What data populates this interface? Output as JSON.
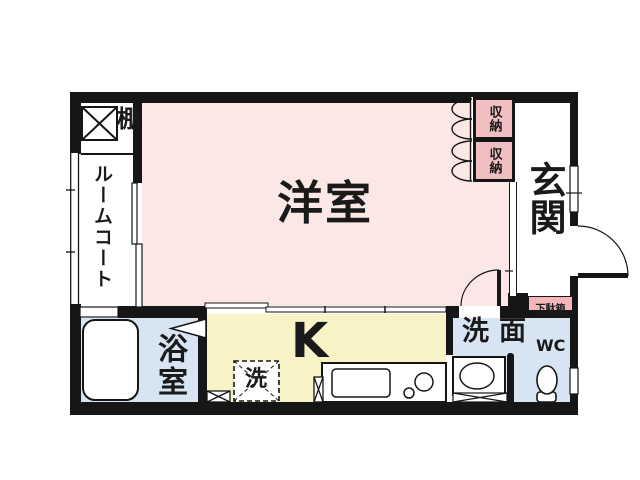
{
  "labels": {
    "western_room": "洋室",
    "entrance": "玄関",
    "kitchen": "K",
    "bathroom": "浴室",
    "washroom": "洗面",
    "toilet": "WC",
    "room_closet": "ルームコート",
    "shelf": "棚",
    "storage_upper": "収納",
    "storage_lower": "収納",
    "shoe_cabinet": "下駄箱",
    "washing_machine": "洗"
  },
  "colors": {
    "background": "#ffffff",
    "wall": "#161616",
    "western_room_fill": "#fbe8e6",
    "water_area_fill": "#d7e4f2",
    "kitchen_fill": "#f7f3c6",
    "storage_fill": "#f1bec1",
    "shoe_cabinet_fill": "#f4b6ba"
  }
}
